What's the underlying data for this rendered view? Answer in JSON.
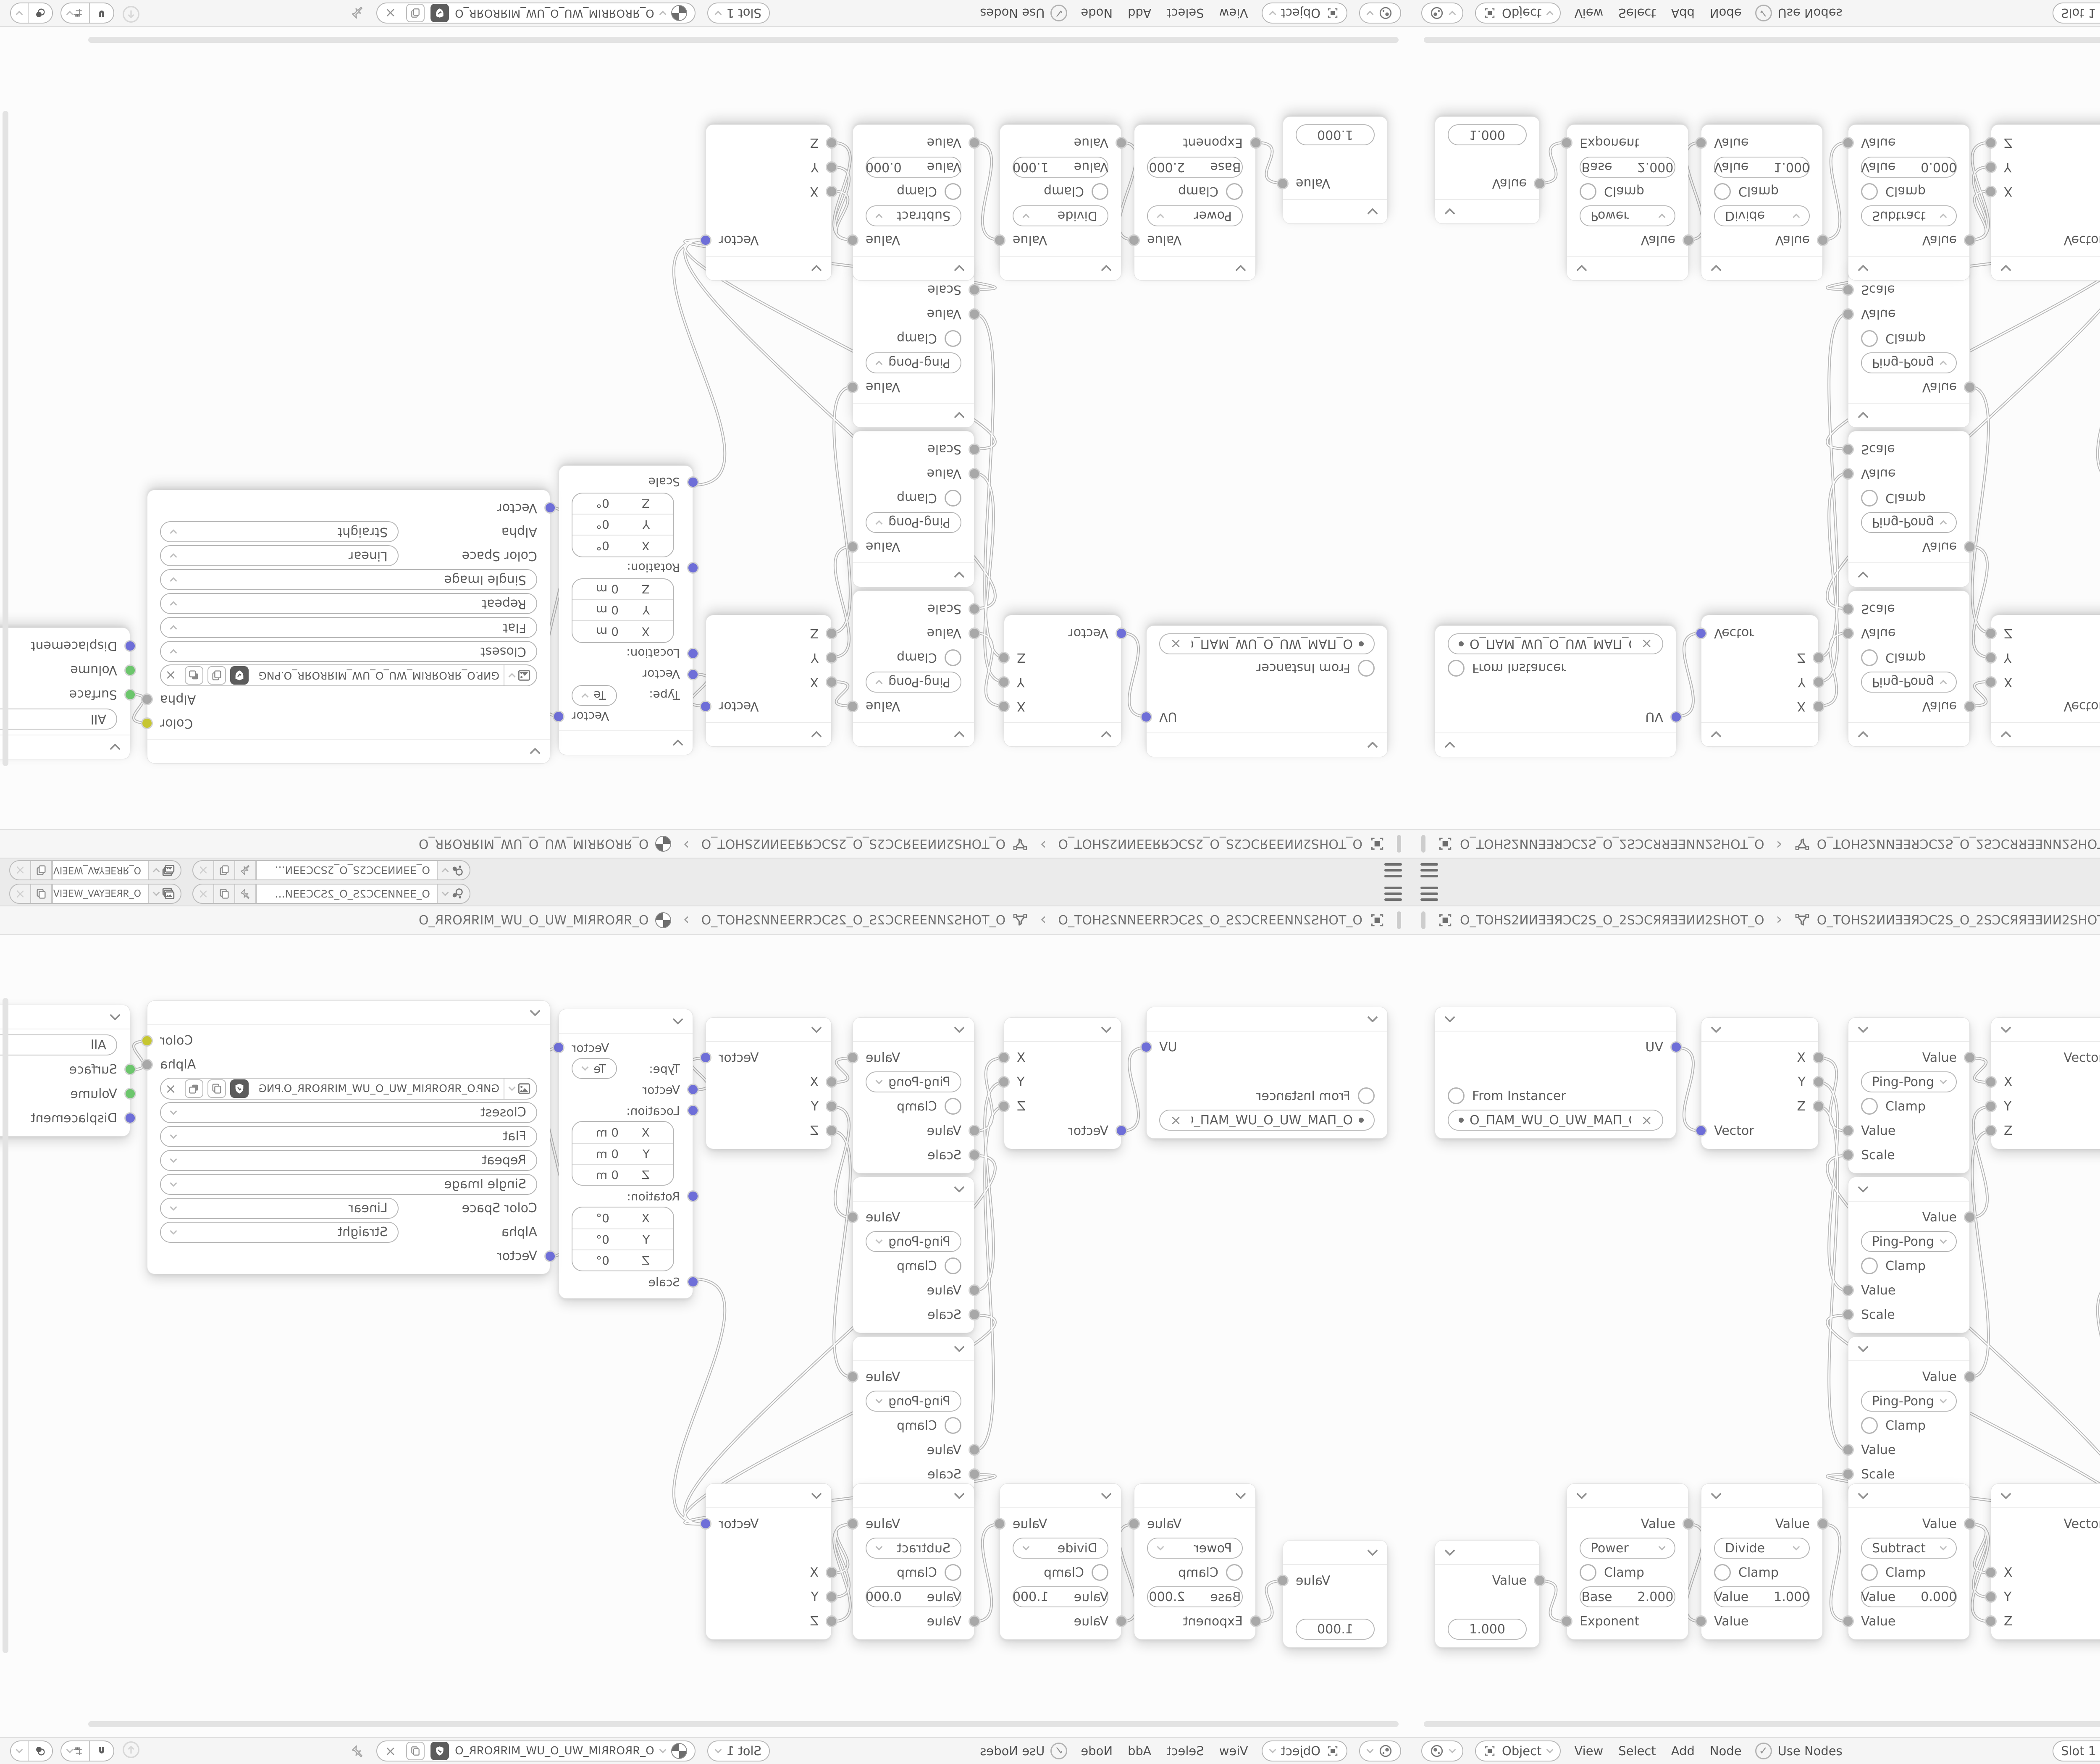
{
  "mirroring": {
    "layout": "2x2 mirrored copies of one Blender-style window",
    "quadrants": [
      "top-left flipped both axes",
      "top-right flipped vertically",
      "bottom-left flipped horizontally",
      "bottom-right normal"
    ]
  },
  "topbar": {
    "scene_selector": {
      "name": "O_ƎƎИИƎƆC2S_O_2SƆCƎƎИ..."
    },
    "view_layer_selector": {
      "name": "O_ЯRƎEYAV_WƎEIV_O_VIƎEW_VAYƎEЯR_O"
    }
  },
  "breadcrumb": {
    "scene": "O_TOHS2ИИƎƎЯƆC2S_O_2SƆCЯЯƎƎИИ2SHOT_O",
    "object": "O_TOHS2ИИƎƎЯƆC2S_O_2SƆCЯЯƎƎИИ2SHOT_O",
    "material": "O_ЯROЯRIM_WU_O_UW_MIЯROЯR_O",
    "separator": "›"
  },
  "editor_header": {
    "shader_type": "Object",
    "menus": {
      "view": "View",
      "select": "Select",
      "add": "Add",
      "node": "Node"
    },
    "use_nodes": "Use Nodes",
    "slot": "Slot 1",
    "material_name": "O_ЯROЯRIM_WU_O_UW_MIЯROЯR_O"
  },
  "nodes": {
    "uv_map": {
      "output": "UV",
      "from_instancer": "From Instancer",
      "uv_name": "O_ПAM_WU_O_UW_MAП_O"
    },
    "separate_xyz": {
      "x": "X",
      "y": "Y",
      "z": "Z",
      "input": "Vector"
    },
    "math_ping_pong": {
      "output": "Value",
      "operation": "Ping-Pong",
      "clamp": "Clamp",
      "input_value": "Value",
      "input_scale": "Scale"
    },
    "combine_xyz": {
      "output": "Vector",
      "x": "X",
      "y": "Y",
      "z": "Z"
    },
    "mapping": {
      "output": "Vector",
      "type_label": "Type:",
      "type": "Texture",
      "input": "Vector",
      "location_label": "Location:",
      "rotation_label": "Rotation:",
      "scale_label": "Scale",
      "axis_x": "X",
      "axis_y": "Y",
      "axis_z": "Z",
      "location_value": "0 m",
      "rotation_value": "0°"
    },
    "image_texture": {
      "output_color": "Color",
      "output_alpha": "Alpha",
      "filename": "GИP.O_ЯROЯRIM_WU_O_UW_MIЯROЯR_O.PNG",
      "interpolation": "Closest",
      "projection": "Flat",
      "extension": "Repeat",
      "source": "Single Image",
      "color_space_label": "Color Space",
      "color_space": "Linear",
      "alpha_label": "Alpha",
      "alpha": "Straight",
      "input": "Vector"
    },
    "material_output": {
      "target": "All",
      "surface": "Surface",
      "volume": "Volume",
      "displacement": "Displacement"
    },
    "value": {
      "output": "Value",
      "value": "1.000"
    },
    "math_power": {
      "output": "Value",
      "operation": "Power",
      "clamp": "Clamp",
      "base_label": "Base",
      "base_value": "2.000",
      "input": "Exponent"
    },
    "math_divide": {
      "output": "Value",
      "operation": "Divide",
      "clamp": "Clamp",
      "value_label": "Value",
      "value": "1.000",
      "input": "Value"
    },
    "math_subtract": {
      "output": "Value",
      "operation": "Subtract",
      "clamp": "Clamp",
      "value_label": "Value",
      "value": "0.000",
      "input": "Value"
    }
  },
  "links": [
    {
      "from": "UV Map.UV",
      "to": "Separate XYZ.Vector"
    },
    {
      "from": "Separate XYZ.X",
      "to": "Math Ping-Pong 1.Value"
    },
    {
      "from": "Separate XYZ.Y",
      "to": "Math Ping-Pong 2.Value"
    },
    {
      "from": "Separate XYZ.Z",
      "to": "Math Ping-Pong 3.Value"
    },
    {
      "from": "Math Ping-Pong 1.Value",
      "to": "Combine XYZ A.X"
    },
    {
      "from": "Math Ping-Pong 2.Value",
      "to": "Combine XYZ A.Y"
    },
    {
      "from": "Math Ping-Pong 3.Value",
      "to": "Combine XYZ A.Z"
    },
    {
      "from": "Combine XYZ A.Vector",
      "to": "Mapping.Vector"
    },
    {
      "from": "Mapping.Vector",
      "to": "Image Texture.Vector"
    },
    {
      "from": "Image Texture.Color",
      "to": "Material Output.Surface"
    },
    {
      "from": "Value.Value",
      "to": "Math Power.Exponent"
    },
    {
      "from": "Math Power.Value",
      "to": "Math Divide.Value"
    },
    {
      "from": "Math Divide.Value",
      "to": "Math Subtract.Value"
    },
    {
      "from": "Math Subtract.Value",
      "to": "Combine XYZ B.X"
    },
    {
      "from": "Math Subtract.Value",
      "to": "Combine XYZ B.Y"
    },
    {
      "from": "Math Subtract.Value",
      "to": "Combine XYZ B.Z"
    },
    {
      "from": "Combine XYZ B.Vector",
      "to": "Math Ping-Pong 1.Scale"
    },
    {
      "from": "Combine XYZ B.Vector",
      "to": "Math Ping-Pong 2.Scale"
    },
    {
      "from": "Combine XYZ B.Vector",
      "to": "Math Ping-Pong 3.Scale"
    },
    {
      "from": "Combine XYZ B.Vector",
      "to": "Mapping.Scale"
    }
  ],
  "icons": {
    "close": "×",
    "check": "✓"
  },
  "colors": {
    "socket_vector": "#6e6ed8",
    "socket_value": "#a8a8a8",
    "socket_color": "#c6c630",
    "socket_shader": "#6cc66c",
    "wire": "#b9b9b9",
    "node_bg": "#ffffff",
    "bar_bg": "#ebebeb",
    "dark_button": "#5c5c5c"
  }
}
